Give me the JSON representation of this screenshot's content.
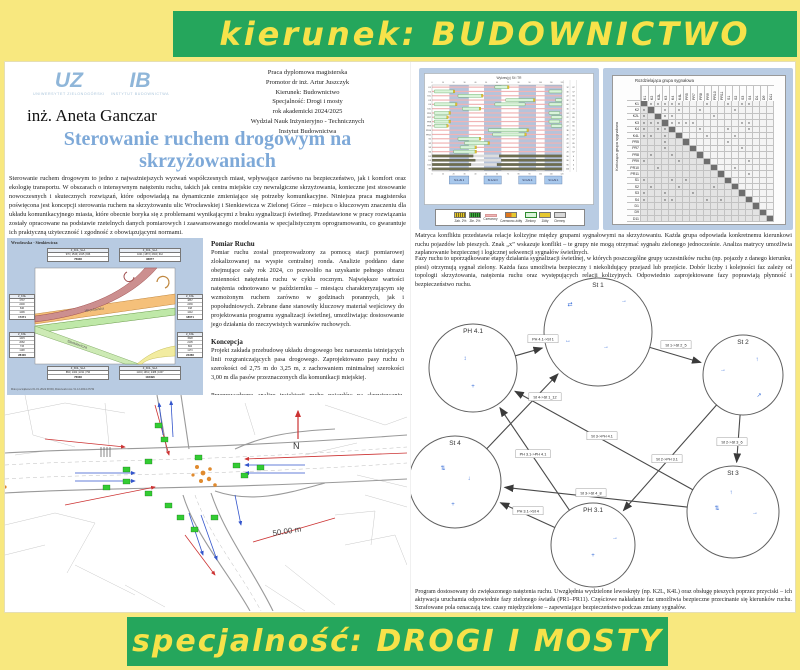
{
  "banners": {
    "top": "kierunek: BUDOWNICTWO",
    "bottom": "specjalność: DROGI I MOSTY"
  },
  "colors": {
    "page_bg": "#f8e87f",
    "banner_green": "#25a65c",
    "banner_text": "#f7e24a",
    "title_blue": "#7ea9d8",
    "panel_blue": "#b9cce3",
    "signal_green": "#2ecc40"
  },
  "header": {
    "logo_uz_abbr": "UZ",
    "logo_uz_name": "UNIWERSYTET ZIELONOGÓRSKI",
    "logo_ib_abbr": "IB",
    "logo_ib_name": "INSTYTUT BUDOWNICTWA",
    "author": "inż. Aneta Ganczar",
    "meta_lines": [
      "Praca dyplomowa magisterska",
      "Promotor dr inż. Artur Juszczyk",
      "Kierunek: Budownictwo",
      "Specjalność: Drogi i mosty",
      "rok akademicki 2024/2025",
      "Wydział Nauk Inżynieryjno - Technicznych",
      "Instytut Budownictwa"
    ]
  },
  "title": "Sterowanie ruchem drogowym na skrzyżowaniach",
  "intro": "Sterowanie ruchem drogowym to jedno z najważniejszych wyzwań współczesnych miast, wpływające zarówno na bezpieczeństwo, jak i komfort oraz ekologię transportu. W obszarach o intensywnym natężeniu ruchu, takich jak centra miejskie czy newralgiczne skrzyżowania, konieczne jest stosowanie nowoczesnych i skutecznych rozwiązań, które odpowiadają na dynamicznie zmieniające się potrzeby komunikacyjne. Niniejsza praca magisterska poświęcona jest koncepcji sterowania ruchem na skrzyżowaniu ulic Wrocławskiej i Sienkiewicza w Zielonej Górze – miejscu o kluczowym znaczeniu dla układu komunikacyjnego miasta, które obecnie boryka się z problemami wynikającymi z braku sygnalizacji świetlnej. Przedstawione w pracy rozwiązania zostały opracowane na podstawie rzetelnych danych pomiarowych i zaawansowanego modelowania w specjalistycznym oprogramowaniu, co gwarantuje ich praktyczną użyteczność i zgodność z obowiązującymi normami.",
  "flow_box": {
    "title": "Wrocławska - Sienkiewicza",
    "street_a": "Wrocławska",
    "street_b": "Sienkiewicza",
    "tables": [
      {
        "header": "Z_KNL_SLA",
        "cells": "970 | 1546 | 2415 | 846",
        "sum": "76936"
      },
      {
        "header": "Z_KNL_SLA",
        "cells": "1021 | 1873 | 2304 | 912",
        "sum": "96877"
      },
      {
        "header": "Z_KNL",
        "rows": [
          "1737",
          "2400",
          "846",
          "1296"
        ],
        "sum": "17371"
      },
      {
        "header": "Z_KNL",
        "rows": [
          "1415",
          "2082",
          "733",
          "1108"
        ],
        "sum": "28400"
      },
      {
        "header": "Z_KNL",
        "rows": [
          "1867",
          "2436",
          "918",
          "1242"
        ],
        "sum": "18671"
      },
      {
        "header": "Z_KNL",
        "rows": [
          "1528",
          "2105",
          "804",
          "1173"
        ],
        "sum": "24366"
      },
      {
        "header": "Z_KNL_SLA",
        "cells": "884 | 1402 | 2211 | 790",
        "sum": "76036"
      },
      {
        "header": "Z_KNL_SLA",
        "cells": "1104 | 1961 | 2488 | 1007",
        "sum": "102496"
      }
    ],
    "footer": "Data początkowa 01.01.2024 00:00, Data końcowa 31.12.2024 23:59"
  },
  "sections": [
    {
      "heading": "Pomiar Ruchu",
      "body": "Pomiar ruchu został przeprowadzony za pomocą stacji pomiarowej zlokalizowanej na wyspie centralnej ronda. Analizie poddano dane obejmujące cały rok 2024, co pozwoliło na uzyskanie pełnego obrazu zmienności natężenia ruchu w cyklu rocznym. Największe wartości natężenia odnotowano w październiku – miesiącu charakteryzującym się wzmożonym ruchem zarówno w godzinach porannych, jak i popołudniowych. Zebrane dane stanowiły kluczowy materiał wejściowy do projektowania programu sygnalizacji świetlnej, umożliwiając dostosowanie jego działania do rzeczywistych warunków ruchowych."
    },
    {
      "heading": "Koncepcja",
      "body": "Projekt zakłada przebudowę układu drogowego bez naruszenia istniejących linii rozgraniczających pasa drogowego. Zaprojektowano pasy ruchu o szerokości od 2,75 m do 3,25 m, z zachowaniem minimalnej szerokości 3,00 m dla pasów przeznaczonych dla komunikacji miejskiej."
    },
    {
      "heading": "",
      "body": "Przeprowadzono analizę trajektorii ruchu pojazdów na skrzyżowaniu. Zidentyfikowano potencjalne punkty kolizji między różnymi kierunkami ruchu. Wyniki pozwalają ocenić bezpieczeństwo układu i zaplanować skuteczne sterowanie sygnalizacją świetlną."
    }
  ],
  "map": {
    "north": "N",
    "scale": "50.00 m"
  },
  "timing": {
    "title": "Wykres(y) St i TR",
    "phases": [
      {
        "label": "St 1+St 2",
        "x": [
          16,
          34
        ]
      },
      {
        "label": "St 2+St 3",
        "x": [
          48,
          64
        ]
      },
      {
        "label": "St 3+St 4",
        "x": [
          80,
          96
        ]
      },
      {
        "label": "St 4+St 1",
        "x": [
          104,
          120
        ]
      }
    ],
    "rows": [
      {
        "label": "K1",
        "type": "veh",
        "bars": [
          [
            58,
            70
          ]
        ],
        "t": [
          12,
          67
        ]
      },
      {
        "label": "K2",
        "type": "veh",
        "bars": [
          [
            2,
            20
          ],
          [
            108,
            120
          ]
        ],
        "t": [
          30,
          57
        ]
      },
      {
        "label": "K2L",
        "type": "veh",
        "bars": [
          [
            24,
            46
          ]
        ],
        "t": [
          22,
          63
        ]
      },
      {
        "label": "K3",
        "type": "veh",
        "bars": [
          [
            68,
            94
          ],
          [
            114,
            120
          ]
        ],
        "t": [
          32,
          55
        ]
      },
      {
        "label": "K4",
        "type": "veh",
        "bars": [
          [
            2,
            22
          ],
          [
            58,
            86
          ],
          [
            108,
            120
          ]
        ],
        "t": [
          60,
          27
        ]
      },
      {
        "label": "K4L",
        "type": "veh",
        "bars": [
          [
            28,
            44
          ]
        ],
        "t": [
          16,
          71
        ]
      },
      {
        "label": "PR5",
        "type": "ped",
        "bars": [
          [
            2,
            16
          ],
          [
            108,
            118
          ]
        ],
        "t": [
          24,
          63
        ]
      },
      {
        "label": "PR7",
        "type": "ped",
        "bars": [
          [
            2,
            14
          ],
          [
            110,
            120
          ]
        ],
        "t": [
          22,
          65
        ]
      },
      {
        "label": "PR8",
        "type": "ped",
        "bars": [
          [
            2,
            16
          ],
          [
            108,
            118
          ]
        ],
        "t": [
          24,
          63
        ]
      },
      {
        "label": "PR9",
        "type": "ped",
        "bars": [
          [
            2,
            14
          ],
          [
            110,
            120
          ]
        ],
        "t": [
          22,
          65
        ]
      },
      {
        "label": "PR10",
        "type": "ped",
        "bars": [
          [
            52,
            88
          ]
        ],
        "t": [
          36,
          51
        ]
      },
      {
        "label": "PR11",
        "type": "ped",
        "bars": [
          [
            56,
            86
          ]
        ],
        "t": [
          30,
          57
        ]
      },
      {
        "label": "S1",
        "type": "veh",
        "bars": [
          [
            24,
            44
          ]
        ],
        "t": [
          20,
          67
        ]
      },
      {
        "label": "S2",
        "type": "veh",
        "bars": [
          [
            30,
            52
          ]
        ],
        "t": [
          22,
          65
        ]
      },
      {
        "label": "S3",
        "type": "veh",
        "bars": [
          [
            26,
            40
          ]
        ],
        "t": [
          14,
          73
        ]
      },
      {
        "label": "S4",
        "type": "veh",
        "bars": [
          [
            20,
            40
          ]
        ],
        "t": [
          20,
          67
        ]
      },
      {
        "label": "D1",
        "type": "aux",
        "bars": [
          [
            0,
            38
          ],
          [
            62,
            120
          ]
        ],
        "t": [
          96,
          0
        ]
      },
      {
        "label": "D9",
        "type": "aux",
        "bars": [
          [
            0,
            40
          ],
          [
            64,
            120
          ]
        ],
        "t": [
          96,
          0
        ]
      },
      {
        "label": "D11",
        "type": "aux",
        "bars": [
          [
            0,
            36
          ],
          [
            60,
            120
          ]
        ],
        "t": [
          96,
          0
        ]
      },
      {
        "label": "TR",
        "type": "aux",
        "bars": [
          [
            0,
            120
          ]
        ],
        "t": [
          120,
          0
        ]
      }
    ],
    "legend": [
      {
        "label": "Zab. 2%",
        "type": "hy"
      },
      {
        "label": "Zie. 2%",
        "type": "hg"
      },
      {
        "label": "Czerwony",
        "type": "red"
      },
      {
        "label": "Czerwono-żółty",
        "type": "ry"
      },
      {
        "label": "Zielony",
        "type": "grn"
      },
      {
        "label": "Żółty",
        "type": "yel"
      },
      {
        "label": "Ciemny",
        "type": "drk"
      }
    ]
  },
  "matrix": {
    "col_axis": "Rozdzielająca grupa sygnałowa",
    "row_axis": "Kończąca grupa sygnałowa",
    "mark": "x",
    "groups": [
      "K1",
      "K2",
      "K2L",
      "K3",
      "K4",
      "K4L",
      "PR5",
      "PR7",
      "PR8",
      "PR9",
      "PR10",
      "PR11",
      "S1",
      "S2",
      "S3",
      "S4",
      "D1",
      "D9",
      "D11"
    ],
    "conflicts": [
      [
        0,
        1
      ],
      [
        0,
        2
      ],
      [
        0,
        3
      ],
      [
        0,
        4
      ],
      [
        0,
        5
      ],
      [
        0,
        9
      ],
      [
        0,
        12
      ],
      [
        0,
        14
      ],
      [
        0,
        15
      ],
      [
        1,
        3
      ],
      [
        1,
        5
      ],
      [
        1,
        8
      ],
      [
        1,
        13
      ],
      [
        2,
        3
      ],
      [
        2,
        4
      ],
      [
        2,
        10
      ],
      [
        3,
        4
      ],
      [
        3,
        5
      ],
      [
        3,
        6
      ],
      [
        3,
        7
      ],
      [
        3,
        14
      ],
      [
        3,
        15
      ],
      [
        4,
        8
      ],
      [
        4,
        12
      ],
      [
        4,
        15
      ],
      [
        5,
        9
      ],
      [
        5,
        13
      ],
      [
        6,
        12
      ],
      [
        7,
        14
      ],
      [
        9,
        15
      ],
      [
        10,
        13
      ],
      [
        11,
        15
      ]
    ]
  },
  "para_matrix": "Matryca konfliktu przedstawia relacje kolizyjne między grupami sygnałowymi na skrzyżowaniu. Każda grupa odpowiada konkretnemu kierunkowi ruchu pojazdów lub pieszych. Znak „x” wskazuje konflikt – te grupy nie mogą otrzymać sygnału zielonego jednocześnie. Analiza matrycy umożliwia zaplanowanie bezpiecznej i logicznej sekwencji sygnałów świetlnych.",
  "para_phases": "Fazy ruchu to uporządkowane etapy działania sygnalizacji świetlnej, w których poszczególne grupy uczestników ruchu (np. pojazdy z danego kierunku, piesi) otrzymują sygnał zielony. Każda faza umożliwia bezpieczny i niekolidujący przejazd lub przejście. Dobór liczby i kolejności faz zależy od topologii skrzyżowania, natężenia ruchu oraz występujących relacji kolizyjnych. Odpowiednio zaprojektowane fazy poprawiają płynność i bezpieczeństwo ruchu.",
  "diagram": {
    "nodes": [
      {
        "id": "St 1",
        "x": 187,
        "y": 62,
        "r": 54,
        "icons": [
          [
            -28,
            -26,
            "⇄"
          ],
          [
            26,
            -30,
            "→"
          ],
          [
            -30,
            10,
            "↔"
          ],
          [
            8,
            16,
            "→"
          ]
        ]
      },
      {
        "id": "PH 4.1",
        "x": 62,
        "y": 98,
        "r": 44,
        "icons": [
          [
            0,
            20,
            "+"
          ],
          [
            -8,
            -8,
            "↕"
          ]
        ]
      },
      {
        "id": "St 2",
        "x": 332,
        "y": 105,
        "r": 40,
        "icons": [
          [
            -20,
            -4,
            "→"
          ],
          [
            14,
            -14,
            "↑"
          ],
          [
            16,
            22,
            "↗"
          ]
        ]
      },
      {
        "id": "St 4",
        "x": 44,
        "y": 212,
        "r": 46,
        "icons": [
          [
            -12,
            -12,
            "⇅"
          ],
          [
            -2,
            24,
            "+"
          ],
          [
            14,
            -2,
            "↓"
          ]
        ]
      },
      {
        "id": "PH 3.1",
        "x": 182,
        "y": 275,
        "r": 42,
        "icons": [
          [
            0,
            12,
            "+"
          ],
          [
            22,
            -6,
            "→"
          ]
        ]
      },
      {
        "id": "St 3",
        "x": 322,
        "y": 242,
        "r": 46,
        "icons": [
          [
            -16,
            -2,
            "⇅"
          ],
          [
            -2,
            -18,
            "↑"
          ],
          [
            22,
            2,
            "→"
          ]
        ]
      }
    ],
    "edges": [
      {
        "from": "PH 4.1",
        "to": "St 1",
        "label": "PH 4.1->St 1",
        "lx": 132,
        "ly": 69
      },
      {
        "from": "St 1",
        "to": "St 2",
        "label": "St 1->St 2_5",
        "lx": 265,
        "ly": 75
      },
      {
        "from": "St 4",
        "to": "St 1",
        "label": "St 4->St 1_12",
        "lx": 134,
        "ly": 127
      },
      {
        "from": "St 3",
        "to": "PH 4.1",
        "label": "St 3->PH 4.1",
        "lx": 191,
        "ly": 166
      },
      {
        "from": "PH 3.1",
        "to": "PH 4.1",
        "label": "PH 3.1->PH 4.1",
        "lx": 122,
        "ly": 184
      },
      {
        "from": "St 2",
        "to": "PH 3.1",
        "label": "St 2->PH 3.1",
        "lx": 256,
        "ly": 189
      },
      {
        "from": "St 2",
        "to": "St 3",
        "label": "St 2->St 3_6",
        "lx": 321,
        "ly": 172
      },
      {
        "from": "St 3",
        "to": "St 4",
        "label": "St 3->St 4_8",
        "lx": 180,
        "ly": 223
      },
      {
        "from": "PH 3.1",
        "to": "St 4",
        "label": "PH 3.1->St 4",
        "lx": 117,
        "ly": 241
      }
    ]
  },
  "caption": "Program dostosowany do zwiększonego natężenia ruchu. Uwzględnia wydzielone lewoskręty (np. K2L, K4L) oraz obsługę pieszych poprzez przyciski – ich aktywacja uruchamia odpowiednie fazy zielonego światła (PR1–PR11). Częściowe nakładanie faz umożliwia bezpieczne przecinanie się kierunków ruchu. Szrafowane pola oznaczają tzw. czasy międzyzielone – zapewniające bezpieczeństwo podczas zmiany sygnałów."
}
